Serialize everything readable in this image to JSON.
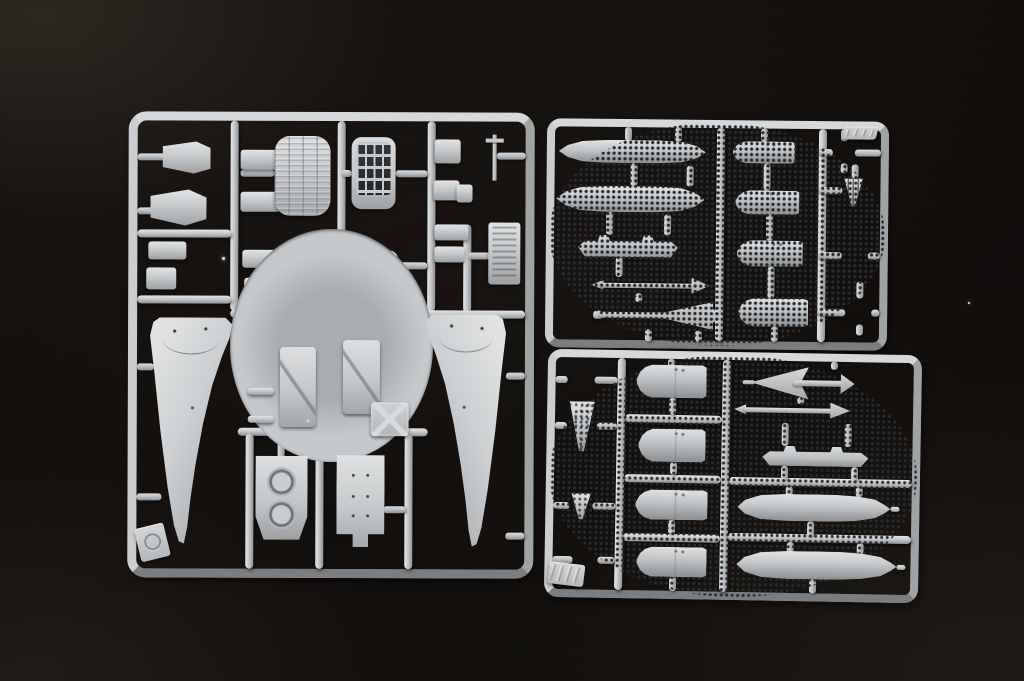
{
  "image": {
    "type": "photograph",
    "subject": "Three light-gray injection-molded plastic model-kit sprues (part runners) laid on a black studio background",
    "sprue_count": 3
  },
  "palette": {
    "plastic_base": "#c6c9cb",
    "plastic_highlight": "#e4e6e7",
    "plastic_shadow": "#8f9395",
    "background": "#0e0b0a",
    "background_warm_tint": "#3a322a"
  },
  "sprues": {
    "left": {
      "name": "Airframe parts sprue",
      "description": "Large square frame holding two slender fuselage halves, a corrugated intake duct, a slotted grille panel, twin-duct engine intake block, equipment-bay panel, cockpit consoles, X-braced hatch, seat back, nose-gear strut, wheel disc, pitot probe and many small fittings",
      "corner_tag": "embossed round logo (illegible)"
    },
    "top_right": {
      "name": "Stores sprue (upper)",
      "description": "Frame with two slender drop tanks, a weapons pylon, a slender rocket, a finned rocket, four bomb half-shells, a hub ring, two perforated flame-holder discs, a slitted cone and a perforated dome",
      "corner_tag": "embossed marking (illegible)"
    },
    "bottom_right": {
      "name": "Stores sprue (lower)",
      "description": "Frame with two perforated flame-holder discs, a perforated cone, a small nozzle cone, four bomb half-shells, a hub ring, a delta-finned missile, a slender rocket, a weapons pylon and two long drop-tank halves",
      "corner_tag": "embossed marking (illegible)"
    }
  }
}
